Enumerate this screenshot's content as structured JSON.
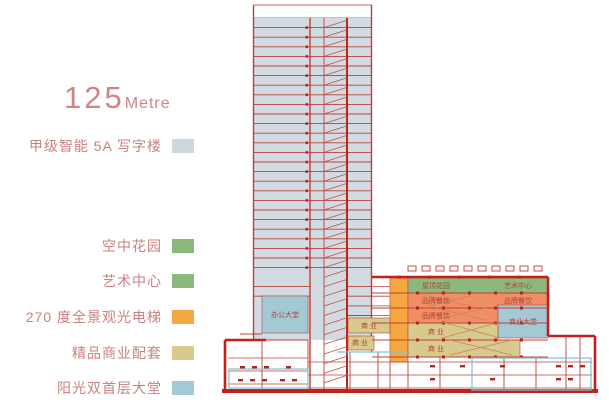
{
  "title": {
    "value": "125",
    "unit": "Metre"
  },
  "legend": {
    "items": [
      {
        "id": "office-tower",
        "label": "甲级智能 5A 写字楼",
        "color": "#ccd7de"
      },
      {
        "id": "sky-garden",
        "label": "空中花园",
        "color": "#8bb97d"
      },
      {
        "id": "art-center",
        "label": "艺术中心",
        "color": "#8bb97d"
      },
      {
        "id": "pano-elevator",
        "label": "270 度全景观光电梯",
        "color": "#f5a841"
      },
      {
        "id": "retail",
        "label": "精品商业配套",
        "color": "#d8ca8c"
      },
      {
        "id": "sun-lobby",
        "label": "阳光双首层大堂",
        "color": "#a2c9d4"
      }
    ]
  },
  "diagram": {
    "colors": {
      "tower_fill": "#d2dbe2",
      "line_red": "#bd4038",
      "thick_red": "#c0211c",
      "dot_red": "#b02620",
      "stair_red": "#c05048",
      "escalator": "#c4826b",
      "garden_green": "#8bb97d",
      "dining_salmon": "#ef8f63",
      "elevator_orange": "#f5a841",
      "retail_tan": "#d8ca8c",
      "lobby_blue": "#a2c9d4",
      "cyan": "#74c6d6",
      "label_red": "#a8443e"
    },
    "blocks": [
      {
        "name": "office-lobby-block",
        "x": 262,
        "y": 296,
        "w": 46,
        "h": 37,
        "fill": "lobby_blue"
      },
      {
        "name": "sightseeing-elevator",
        "x": 390,
        "y": 278,
        "w": 18,
        "h": 84,
        "fill": "elevator_orange"
      },
      {
        "name": "roof-garden-band",
        "x": 408,
        "y": 278,
        "w": 140,
        "h": 15,
        "fill": "garden_green"
      },
      {
        "name": "dining-band-1",
        "x": 408,
        "y": 293,
        "w": 140,
        "h": 15,
        "fill": "dining_salmon"
      },
      {
        "name": "dining-band-2",
        "x": 408,
        "y": 308,
        "w": 90,
        "h": 15,
        "fill": "dining_salmon"
      },
      {
        "name": "commercial-lobby-block",
        "x": 498,
        "y": 305,
        "w": 50,
        "h": 33,
        "fill": "lobby_blue"
      },
      {
        "name": "retail-band-1",
        "x": 408,
        "y": 323,
        "w": 90,
        "h": 17,
        "fill": "retail_tan"
      },
      {
        "name": "retail-band-2",
        "x": 408,
        "y": 340,
        "w": 112,
        "h": 17,
        "fill": "retail_tan"
      },
      {
        "name": "retail-small-1",
        "x": 348,
        "y": 318,
        "w": 42,
        "h": 15,
        "fill": "retail_tan"
      },
      {
        "name": "retail-small-2",
        "x": 348,
        "y": 336,
        "w": 26,
        "h": 14,
        "fill": "retail_tan"
      }
    ],
    "block_labels": [
      {
        "name": "office-lobby-label",
        "text": "办公大堂",
        "x": 285,
        "y": 317
      },
      {
        "name": "roof-garden-label",
        "text": "屋顶花园",
        "x": 436,
        "y": 288
      },
      {
        "name": "art-center-label",
        "text": "艺术中心",
        "x": 518,
        "y": 288
      },
      {
        "name": "dining-left-label",
        "text": "品牌餐饮",
        "x": 436,
        "y": 303
      },
      {
        "name": "dining-right-label",
        "text": "品牌餐饮",
        "x": 518,
        "y": 303
      },
      {
        "name": "dining-left2-label",
        "text": "品牌餐饮",
        "x": 436,
        "y": 318
      },
      {
        "name": "commercial-lobby-label",
        "text": "商业大堂",
        "x": 523,
        "y": 324
      },
      {
        "name": "retail-1-label",
        "text": "商 业",
        "x": 436,
        "y": 334
      },
      {
        "name": "retail-2-label",
        "text": "商 业",
        "x": 436,
        "y": 351
      },
      {
        "name": "retail-3-label",
        "text": "商 业",
        "x": 369,
        "y": 328
      },
      {
        "name": "retail-4-label",
        "text": "商 业",
        "x": 360,
        "y": 345
      }
    ]
  }
}
